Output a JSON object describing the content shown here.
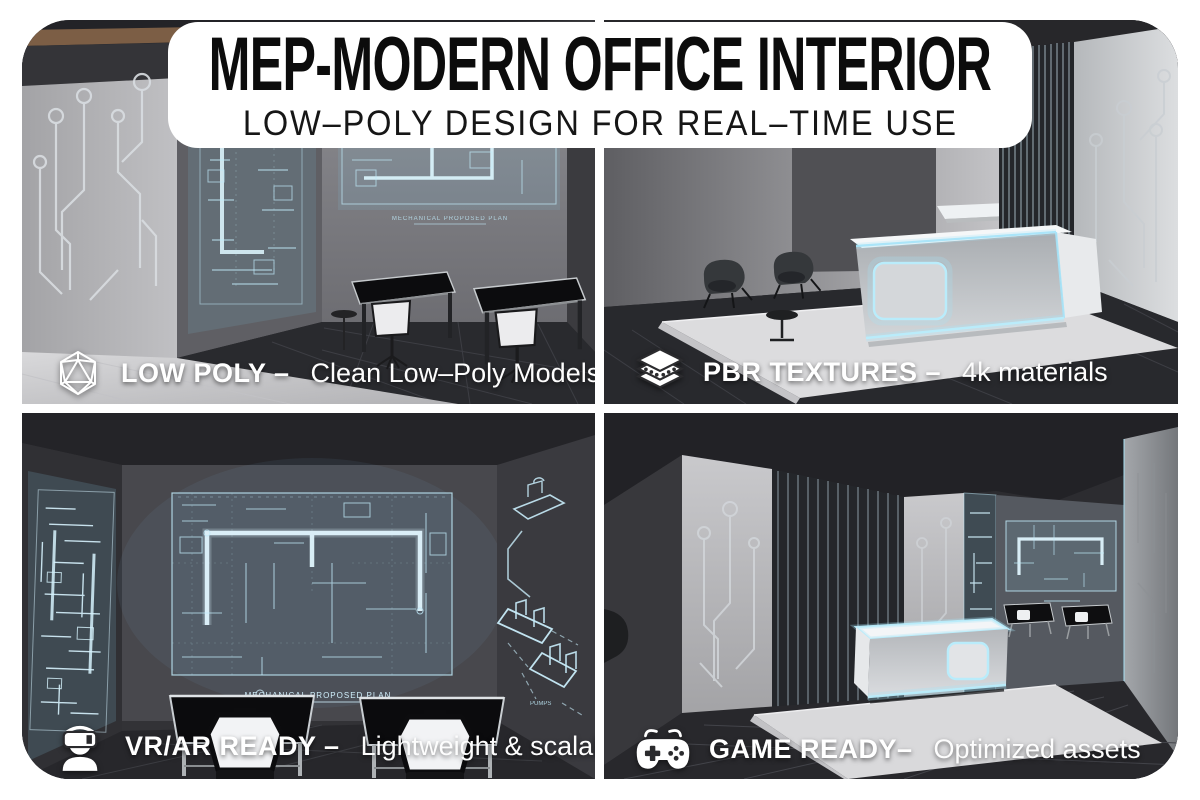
{
  "banner": {
    "title": "MEP-MODERN OFFICE INTERIOR",
    "subtitle": "LOW–POLY DESIGN FOR REAL–TIME USE"
  },
  "features": [
    {
      "id": "low-poly",
      "icon": "icosahedron-wireframe-icon",
      "title": "LOW POLY –",
      "desc": "Clean Low–Poly Models"
    },
    {
      "id": "pbr-textures",
      "icon": "layers-icon",
      "title": "PBR TEXTURES –",
      "desc": "4k materials"
    },
    {
      "id": "vr-ar-ready",
      "icon": "vr-headset-person-icon",
      "title": "VR/AR READY –",
      "desc": "Lightweight & scalable"
    },
    {
      "id": "game-ready",
      "icon": "gamepad-icon",
      "title": "GAME READY–",
      "desc": "Optimized assets"
    }
  ],
  "scene_text": {
    "blueprint_caption": "MECHANICAL PROPOSED PLAN",
    "pipes_label": "PUMPS"
  },
  "colors": {
    "accent_cyan": "#aee3f7",
    "banner_bg": "#ffffff",
    "banner_text": "#0c0c0c",
    "caption_text": "#ffffff",
    "floor_dark": "#28292d",
    "concrete": "#b9bcbf"
  }
}
